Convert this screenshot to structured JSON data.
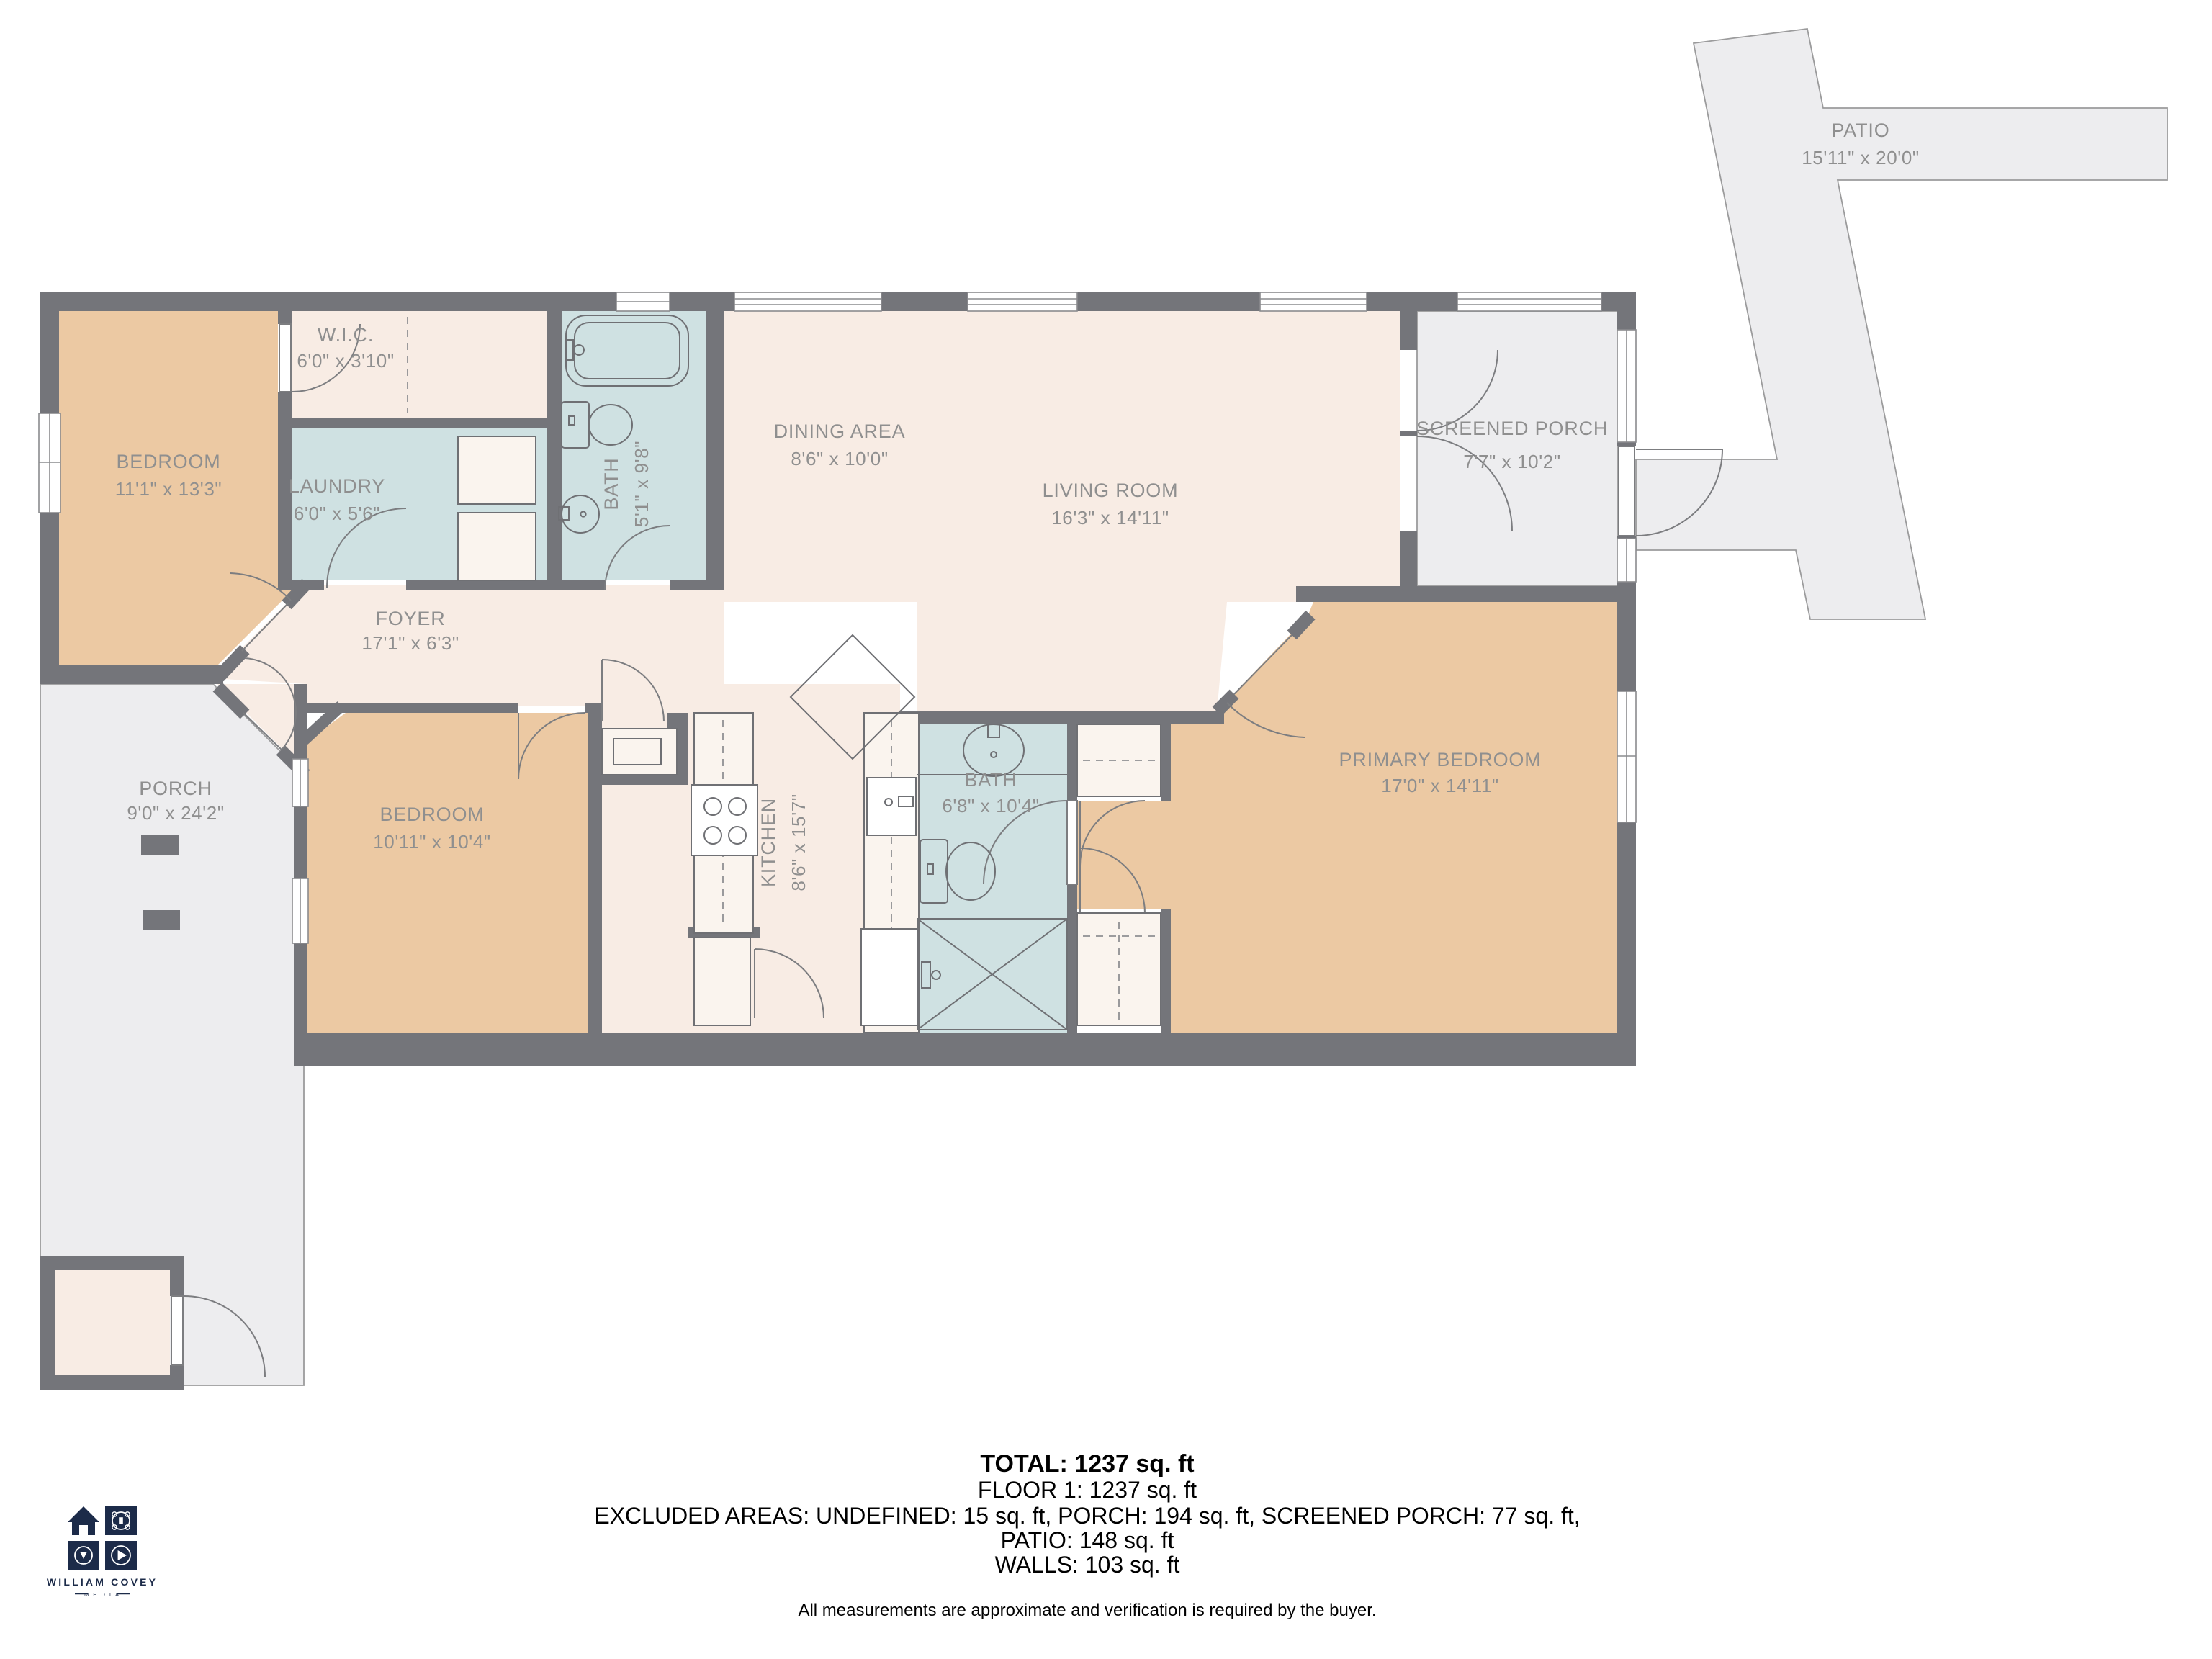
{
  "rooms": {
    "patio": {
      "name": "PATIO",
      "dims": "15'11\" x 20'0\""
    },
    "bedroom1": {
      "name": "BEDROOM",
      "dims": "11'1\" x 13'3\""
    },
    "wic": {
      "name": "W.I.C.",
      "dims": "6'0\" x 3'10\""
    },
    "laundry": {
      "name": "LAUNDRY",
      "dims": "6'0\" x 5'6\""
    },
    "bath1": {
      "name": "BATH",
      "dims": "5'1\" x 9'8\""
    },
    "dining": {
      "name": "DINING AREA",
      "dims": "8'6\" x 10'0\""
    },
    "living": {
      "name": "LIVING ROOM",
      "dims": "16'3\" x 14'11\""
    },
    "screened_porch": {
      "name": "SCREENED PORCH",
      "dims": "7'7\" x 10'2\""
    },
    "foyer": {
      "name": "FOYER",
      "dims": "17'1\" x 6'3\""
    },
    "bedroom2": {
      "name": "BEDROOM",
      "dims": "10'11\" x 10'4\""
    },
    "kitchen": {
      "name": "KITCHEN",
      "dims": "8'6\" x 15'7\""
    },
    "bath2": {
      "name": "BATH",
      "dims": "6'8\" x 10'4\""
    },
    "primary_bedroom": {
      "name": "PRIMARY BEDROOM",
      "dims": "17'0\" x 14'11\""
    },
    "porch": {
      "name": "PORCH",
      "dims": "9'0\" x 24'2\""
    }
  },
  "summary": {
    "total": "TOTAL: 1237 sq. ft",
    "floor": "FLOOR 1: 1237 sq. ft",
    "excluded": "EXCLUDED AREAS: UNDEFINED: 15 sq. ft, PORCH: 194 sq. ft, SCREENED PORCH: 77 sq. ft,",
    "patio_line": "PATIO: 148 sq. ft",
    "walls_line": "WALLS: 103 sq. ft",
    "disclaimer": "All measurements are approximate and verification is required by the buyer."
  },
  "branding": {
    "name": "WILLIAM COVEY",
    "sub": "MEDIA"
  },
  "colors": {
    "wall": "#74757a",
    "bedroom_fill": "#ecc9a3",
    "living_fill": "#f8ece4",
    "bath_fill": "#cfe1e2",
    "outdoor_fill": "#ededef",
    "label_text": "#8f8f8f",
    "logo_navy": "#1c2b49"
  }
}
